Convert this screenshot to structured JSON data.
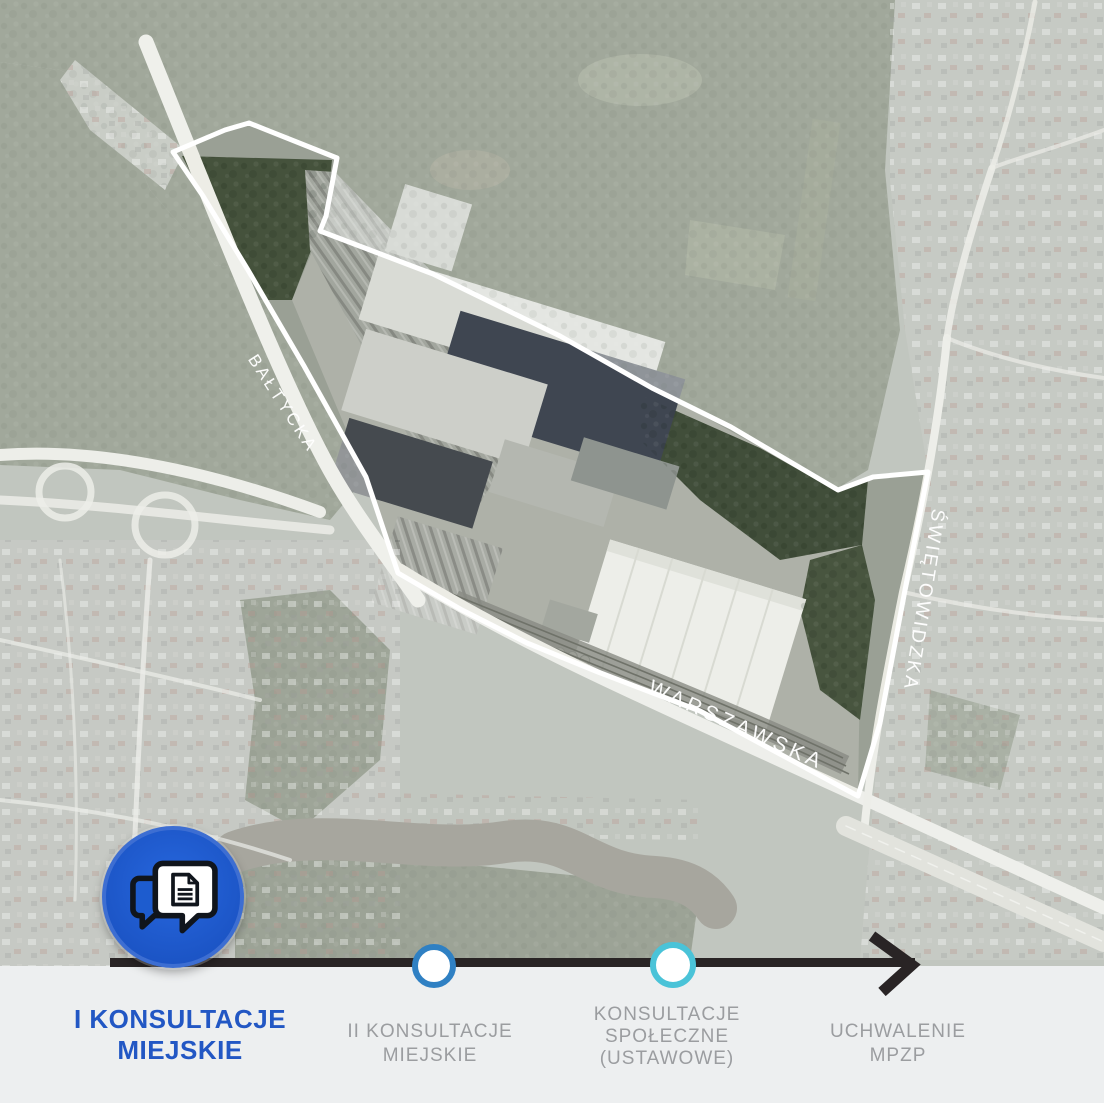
{
  "map": {
    "type": "satellite-aerial",
    "streets": [
      {
        "name": "BAŁTYCKA"
      },
      {
        "name": "WARSZAWSKA"
      },
      {
        "name": "ŚWIĘTOWIDZKA"
      }
    ],
    "boundary_color": "#ffffff"
  },
  "timeline": {
    "bar_background": "#edeff0",
    "line_color": "#292425",
    "steps": [
      {
        "label": "I KONSULTACJE MIEJSKIE",
        "state": "active",
        "marker": "consultation-bubbles-icon",
        "accent": "#1d5ccf",
        "text_color": "#2257c4"
      },
      {
        "label": "II KONSULTACJE MIEJSKIE",
        "state": "upcoming",
        "marker": "circle",
        "accent": "#2f80c3",
        "text_color": "#9b9da0"
      },
      {
        "label": "KONSULTACJE SPOŁECZNE (USTAWOWE)",
        "state": "upcoming",
        "marker": "circle",
        "accent": "#4ac3d8",
        "text_color": "#9b9da0"
      },
      {
        "label": "UCHWALENIE MPZP",
        "state": "upcoming",
        "marker": "arrow",
        "accent": "#292425",
        "text_color": "#9b9da0"
      }
    ]
  }
}
